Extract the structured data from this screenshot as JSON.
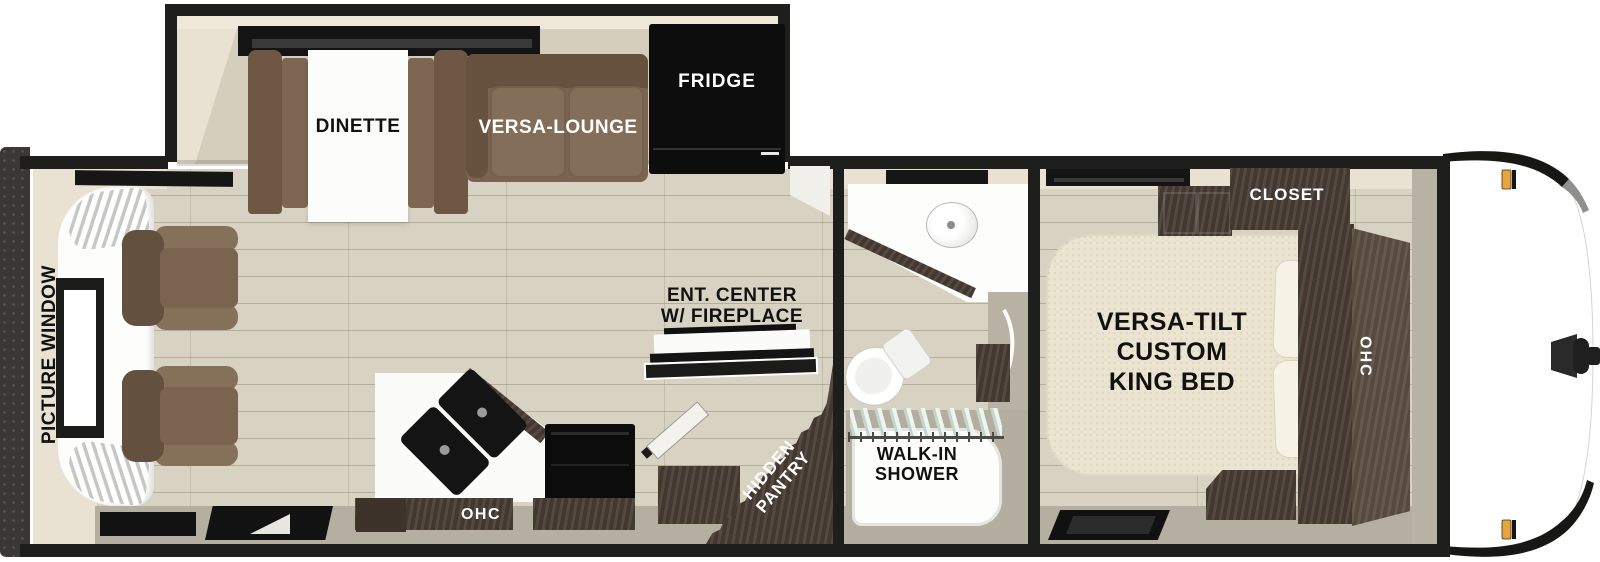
{
  "plan": {
    "title": "Travel trailer RV floor plan, top-down view",
    "labels": {
      "picture_window": "PICTURE WINDOW",
      "dinette": "DINETTE",
      "versa_lounge": "VERSA-LOUNGE",
      "fridge": "FRIDGE",
      "ent_center_line1": "ENT. CENTER",
      "ent_center_line2": "W/ FIREPLACE",
      "kitchen_ohc": "OHC",
      "hidden_pantry_line1": "HIDDEN",
      "hidden_pantry_line2": "PANTRY",
      "walk_in_shower_line1": "WALK-IN",
      "walk_in_shower_line2": "SHOWER",
      "closet": "CLOSET",
      "king_bed_line1": "VERSA-TILT",
      "king_bed_line2": "CUSTOM",
      "king_bed_line3": "KING BED",
      "bedroom_ohc": "OHC"
    },
    "unlabeled_fixtures": [
      "slide-out with dinette, versa-lounge sofa and fridge",
      "two recliner chairs at rear picture window",
      "kitchen counter with double sink and range",
      "entry door",
      "bathroom corner vanity sink and toilet",
      "king bed with pillows and nightstand",
      "front cap with hitch and amber marker lights"
    ],
    "colors": {
      "wall": "#1e1e1c",
      "wall_face_cream": "#e9e2d2",
      "floor_wood": "#d8d2c2",
      "apron_gray": "#b4afa0",
      "sofa_brown": "#7a6450",
      "cabinet_darkwood": "#4a3e35",
      "bed_cream": "#eae4d0",
      "counter_white": "#fbfbf9",
      "marker_amber": "#e7a63d"
    }
  }
}
